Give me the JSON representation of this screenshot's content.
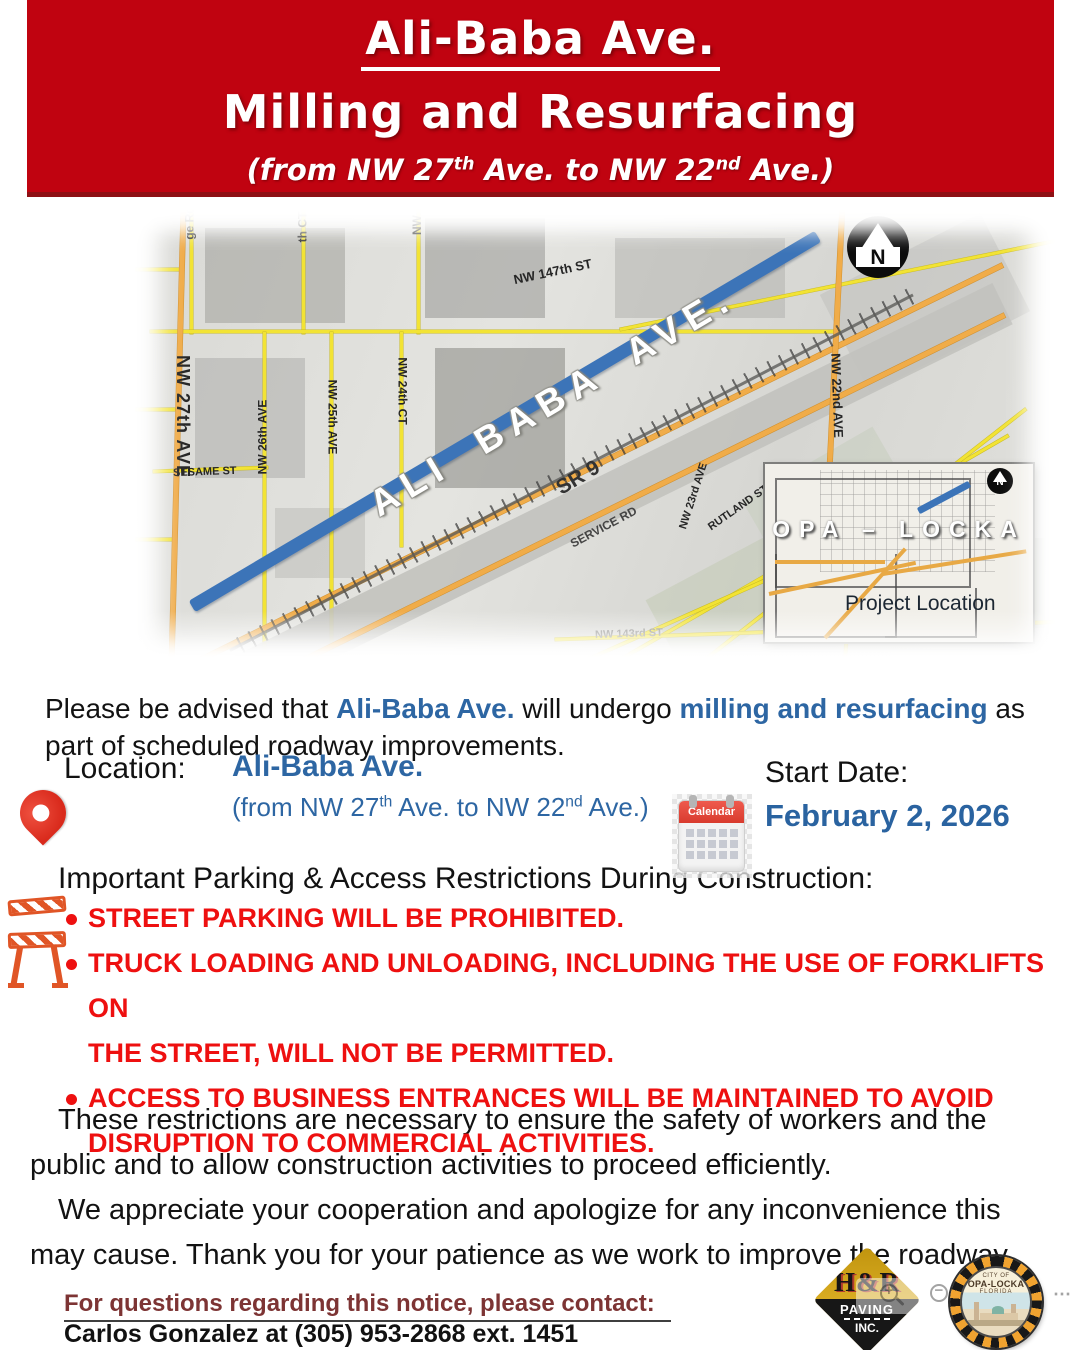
{
  "colors": {
    "banner_red": "#c00310",
    "accent_blue": "#2d66a3",
    "bullet_red": "#ee1010",
    "contact_maroon": "#7d3434",
    "road_blue": "#3c74b8"
  },
  "banner": {
    "title": "Ali-Baba Ave.",
    "subtitle": "Milling and Resurfacing",
    "range": {
      "p1": "(from NW 27",
      "s1": "th",
      "p2": " Ave. to NW 22",
      "s2": "nd",
      "p3": " Ave.)"
    }
  },
  "map": {
    "road_label": "ALI BABA AVE.",
    "north_letter": "N",
    "street_labels": [
      "ge Rd",
      "th CT",
      "NW",
      "NW 147th ST",
      "NW 27th AVE",
      "NW 26th AVE",
      "NW 25th AVE",
      "NW 24th CT",
      "SESAME ST",
      "SR 9",
      "SERVICE RD",
      "NW 23rd AVE",
      "RUTLAND ST",
      "NW 143rd ST",
      "NW 22nd AVE"
    ],
    "inset": {
      "region": "OPA – LOCKA",
      "caption": "Project Location",
      "north_letter": "N"
    }
  },
  "intro": {
    "l1": {
      "t1": "Please be advised that ",
      "hl1": "Ali-Baba Ave.",
      "t2": " will undergo ",
      "hl2": "milling and resurfacing",
      "t3": " as"
    },
    "l2": "part of scheduled roadway improvements."
  },
  "location": {
    "label": "Location:",
    "name": "Ali-Baba Ave.",
    "range": {
      "p1": "(from NW 27",
      "s1": "th",
      "p2": " Ave. to NW 22",
      "s2": "nd",
      "p3": " Ave.)"
    }
  },
  "start": {
    "label": "Start Date:",
    "date": "February 2, 2026"
  },
  "calendar_icon_label": "Calendar",
  "restrictions": {
    "heading": "Important Parking & Access Restrictions During Construction:",
    "items": [
      {
        "lines": [
          "STREET PARKING WILL BE PROHIBITED."
        ]
      },
      {
        "lines": [
          "TRUCK LOADING AND UNLOADING, INCLUDING THE USE OF FORKLIFTS ON",
          "THE STREET, WILL NOT BE PERMITTED."
        ]
      },
      {
        "lines": [
          "ACCESS TO BUSINESS ENTRANCES WILL BE MAINTAINED TO AVOID",
          "DISRUPTION TO COMMERCIAL ACTIVITIES."
        ]
      }
    ]
  },
  "closing": {
    "p1": {
      "l1": "These restrictions are necessary to ensure the safety of workers and the",
      "l2": "public and to allow construction activities to proceed efficiently."
    },
    "p2": {
      "l1": "We appreciate your cooperation and apologize for any inconvenience this",
      "l2": "may cause. Thank you for your patience as we work to improve the roadway."
    }
  },
  "footer": {
    "contact_label": "For questions regarding this notice, please contact:",
    "contact_info": "Carlos Gonzalez  at (305) 953-2868 ext. 1451"
  },
  "logos": {
    "hr": {
      "top": "H&R",
      "mid": "PAVING",
      "bot": "INC."
    },
    "seal": {
      "l1": "CITY OF",
      "l2": "OPA-LOCKA",
      "l3": "FLORIDA"
    }
  },
  "viewer": {
    "more": "⋯"
  }
}
